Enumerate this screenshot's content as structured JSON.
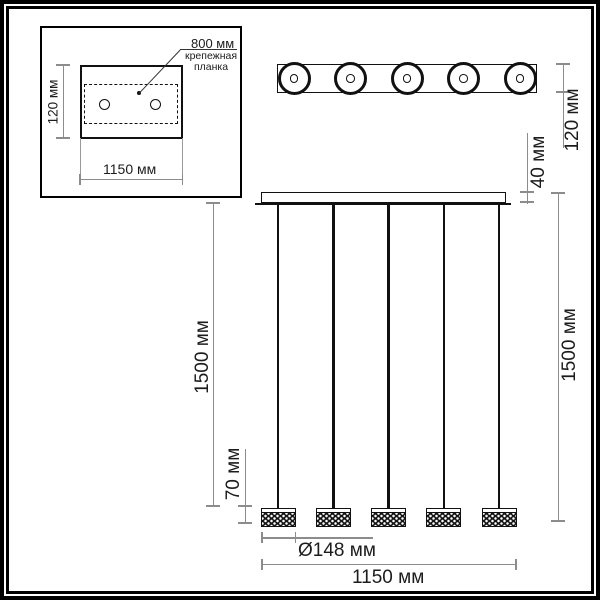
{
  "drawing": {
    "inset": {
      "callout_value": "800 мм",
      "callout_label_lines": [
        "крепежная",
        "планка"
      ],
      "plate_height": "120 мм",
      "plate_width": "1150 мм"
    },
    "top_view": {
      "bar_height": "120 мм"
    },
    "front_view": {
      "canopy_height": "40 мм",
      "cable_drop_left": "1500 мм",
      "cable_drop_right": "1500 мм",
      "shade_height": "70 мм",
      "shade_diameter": "Ø148 мм",
      "overall_width": "1150 мм"
    }
  },
  "colors": {
    "ink": "#1a1a1a",
    "dimension_line": "#8c8c8c",
    "background": "#ffffff"
  }
}
